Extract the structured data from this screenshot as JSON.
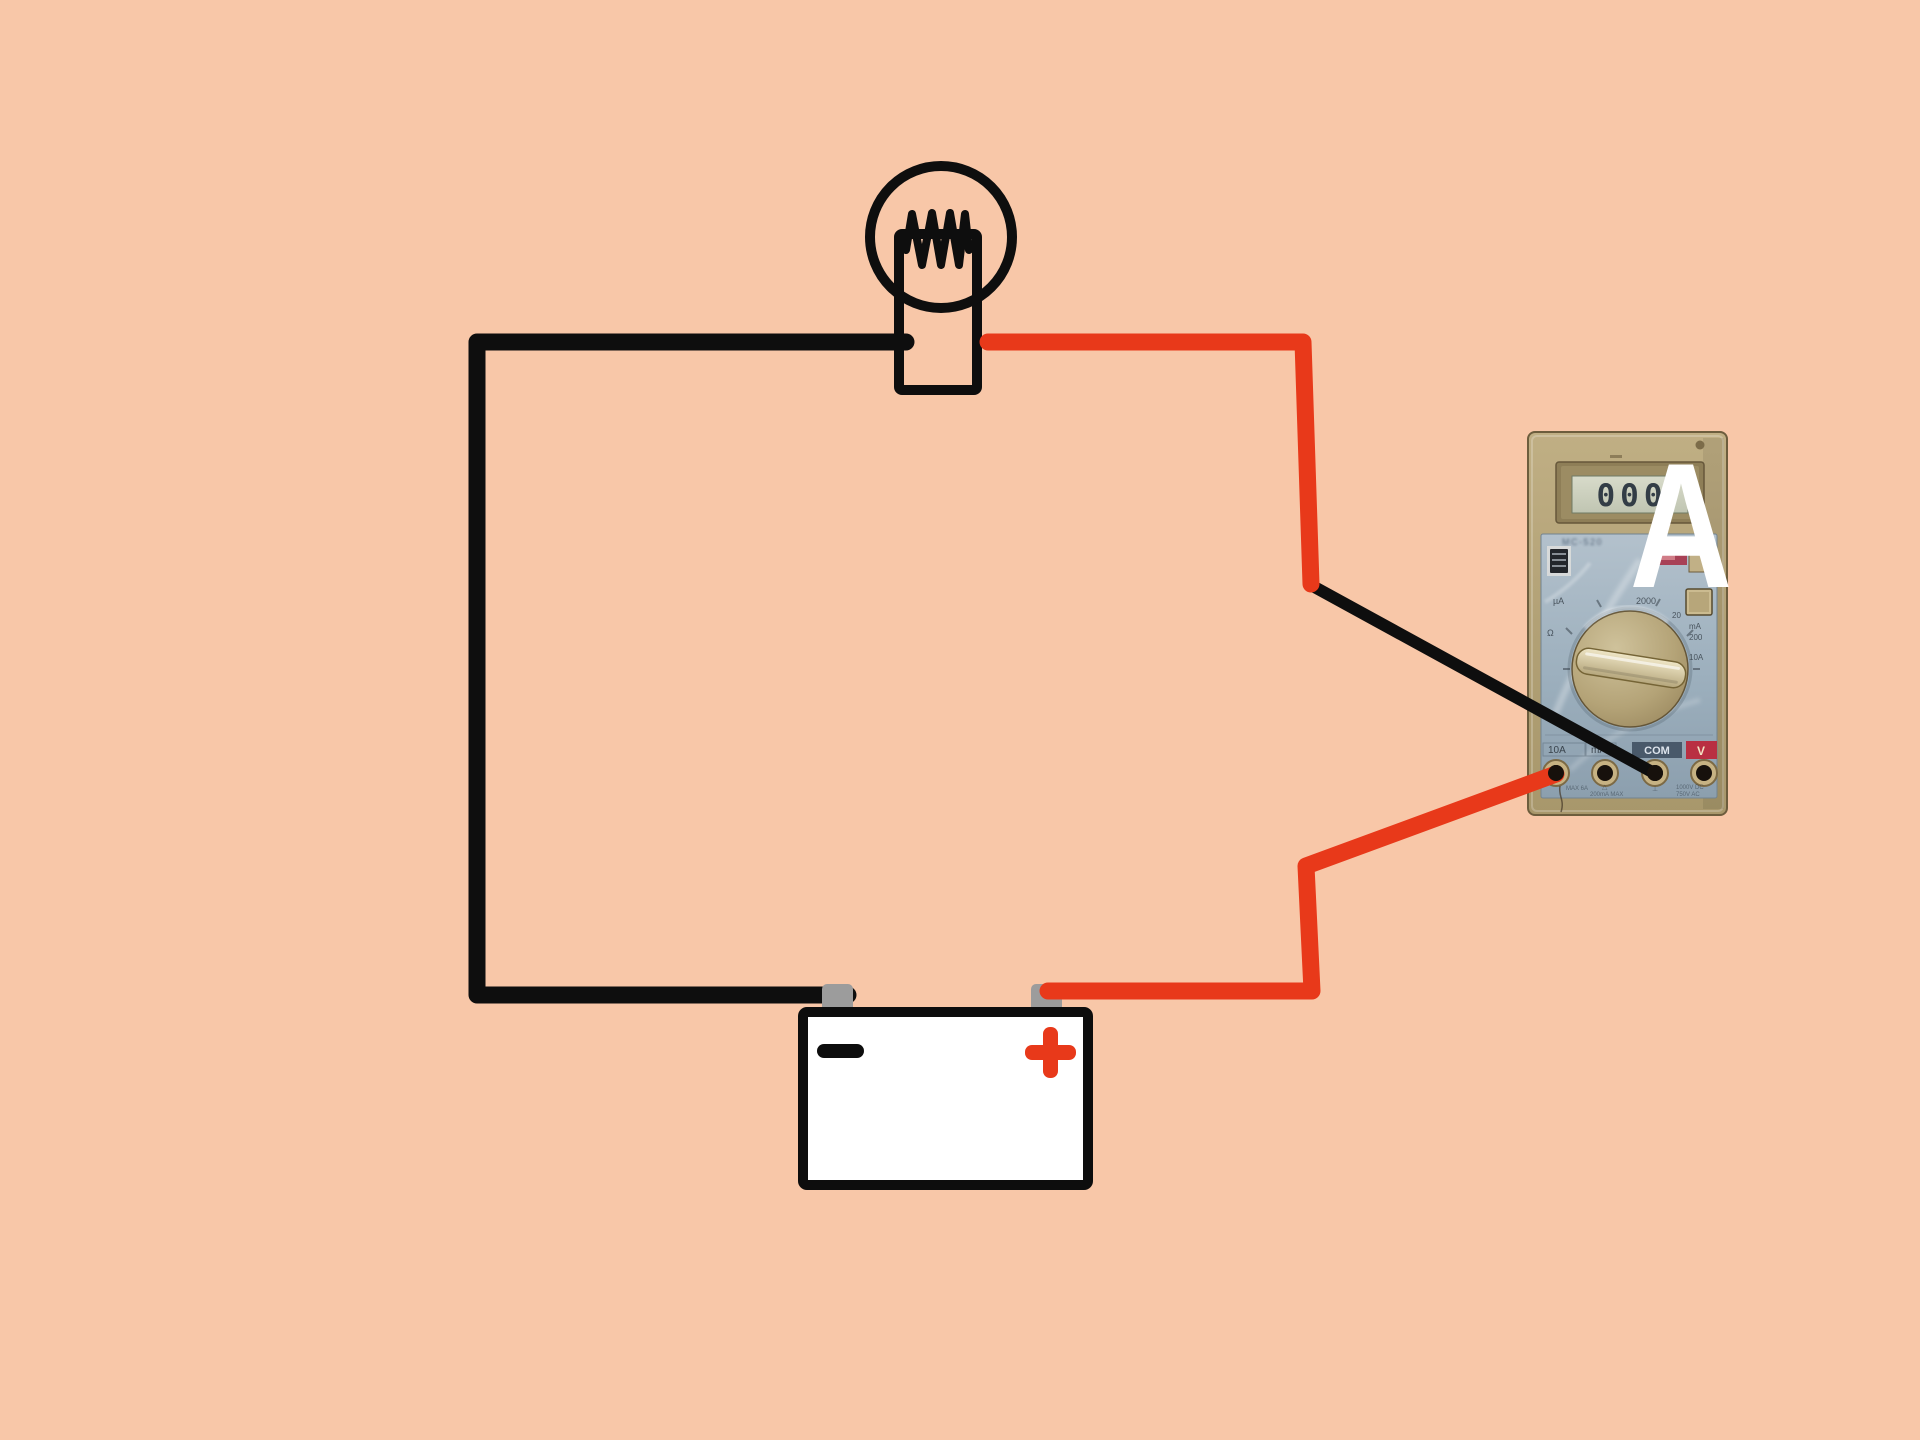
{
  "scene": {
    "background_color": "#f8c7a8",
    "wire_red": "#e8391a",
    "wire_black": "#0e0e0e",
    "terminal_gray": "#9c9c9c",
    "description": "Circuit diagram: battery powering a light bulb with a multimeter (ammeter) wired in series"
  },
  "battery": {
    "minus_symbol": "−",
    "plus_symbol": "+"
  },
  "multimeter": {
    "display_value": "000",
    "overlay_letter": "A",
    "model_text": "MC-520",
    "panel_labels": {
      "ua": "µA",
      "ohm": "Ω",
      "r2000": "2000",
      "r20": "20",
      "ma": "mA",
      "r200": "200",
      "a10": "10A"
    },
    "jack_labels": {
      "a10": "10A",
      "ma": "mA",
      "com": "COM",
      "v": "V"
    },
    "fine_print": {
      "l1": "MAX 6A",
      "l2": "200mA MAX",
      "l3": "1000V DC",
      "l4": "750V AC",
      "warn": "△",
      "gnd": "⊥"
    }
  }
}
